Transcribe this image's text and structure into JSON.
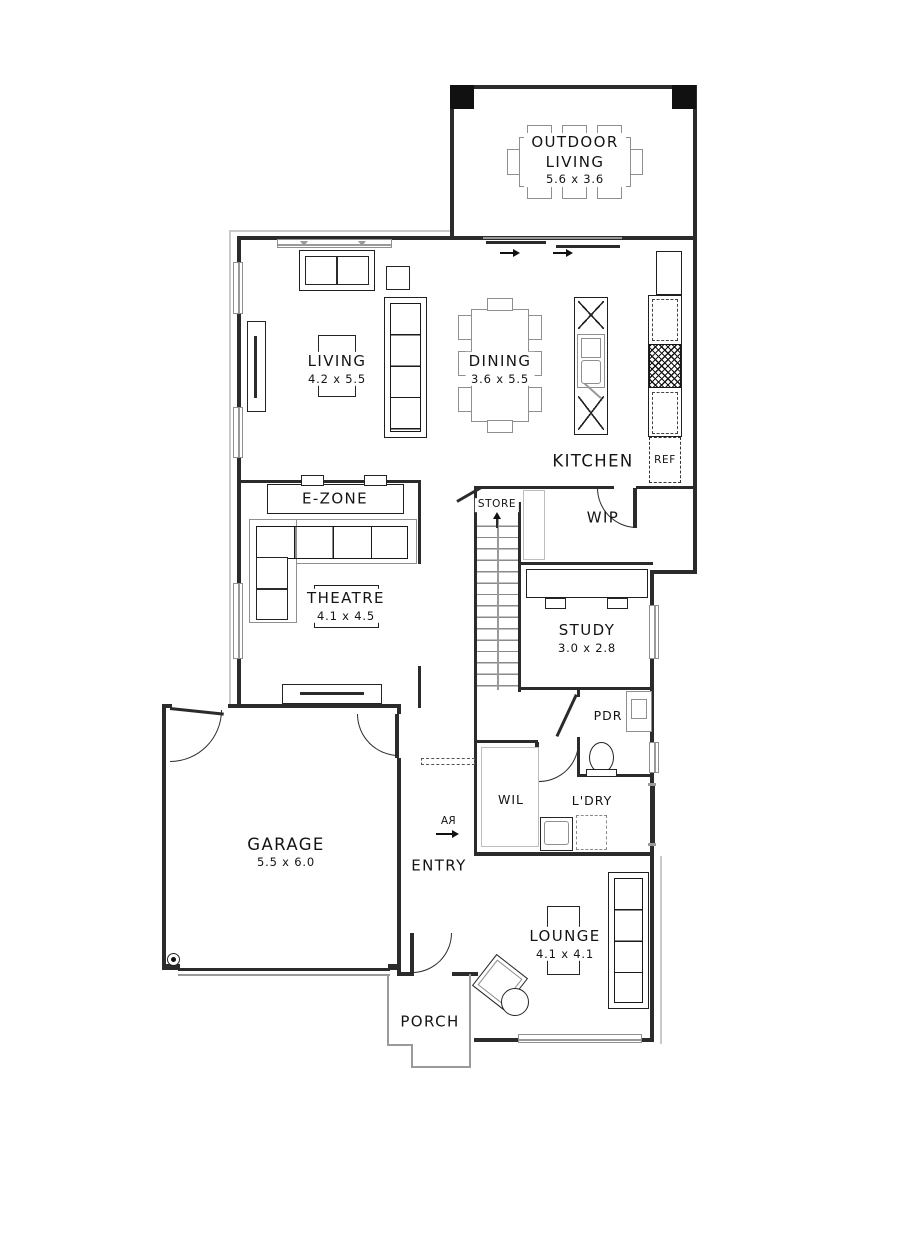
{
  "plan_title": "Ground Floor Plan",
  "rooms": {
    "outdoor_living": {
      "name": "OUTDOOR LIVING",
      "dims": "5.6 x 3.6"
    },
    "living": {
      "name": "LIVING",
      "dims": "4.2 x 5.5"
    },
    "dining": {
      "name": "DINING",
      "dims": "3.6 x 5.5"
    },
    "kitchen": {
      "name": "KITCHEN"
    },
    "wip": {
      "name": "WIP"
    },
    "store": {
      "name": "STORE"
    },
    "ezone": {
      "name": "E-ZONE"
    },
    "theatre": {
      "name": "THEATRE",
      "dims": "4.1 x 4.5"
    },
    "study": {
      "name": "STUDY",
      "dims": "3.0 x 2.8"
    },
    "pdr": {
      "name": "PDR"
    },
    "wil": {
      "name": "WIL"
    },
    "ldry": {
      "name": "L'DRY"
    },
    "garage": {
      "name": "GARAGE",
      "dims": "5.5 x 6.0"
    },
    "entry": {
      "name": "ENTRY"
    },
    "lounge": {
      "name": "LOUNGE",
      "dims": "4.1 x 4.1"
    },
    "porch": {
      "name": "PORCH"
    }
  },
  "appliances": {
    "fridge": "REF"
  },
  "symbols": {
    "return_air": "RA"
  }
}
